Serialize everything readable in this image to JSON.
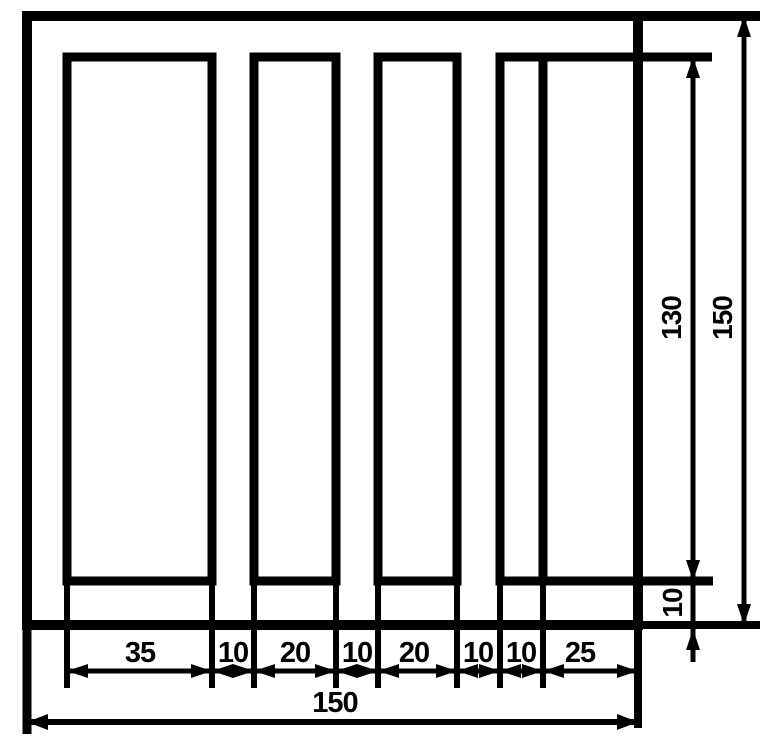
{
  "colors": {
    "line": "#000000",
    "background": "#ffffff"
  },
  "dims": {
    "row1": [
      "35",
      "10",
      "20",
      "10",
      "20",
      "10",
      "10",
      "25"
    ],
    "total_width": "150",
    "slot_depth": "130",
    "total_height": "150",
    "bottom_web": "10"
  }
}
